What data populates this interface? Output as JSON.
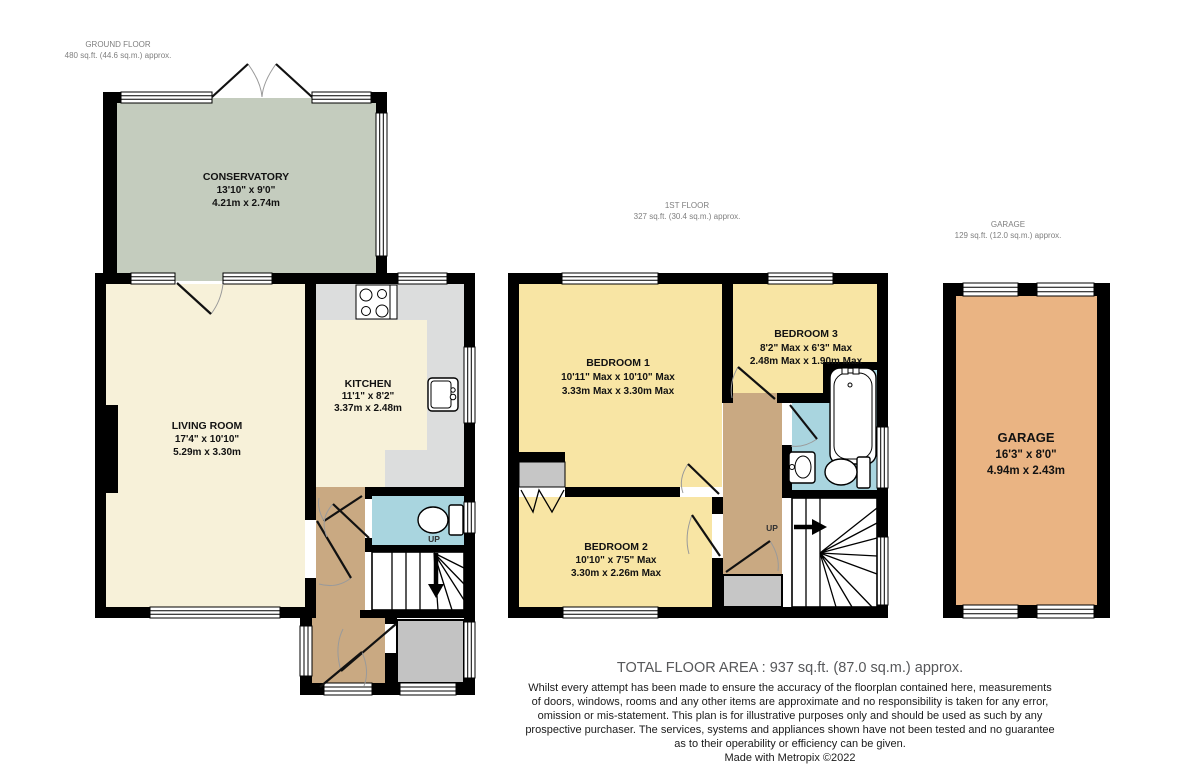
{
  "colors": {
    "wall": "#000000",
    "cream": "#f7f1d9",
    "yellow": "#f8e5a4",
    "green": "#c4ccbe",
    "tan": "#c9a982",
    "blue": "#a9d5df",
    "orange": "#eab483",
    "counter": "#dcdddd",
    "porch": "#c3c3c3",
    "cupboard": "#c6c6c6"
  },
  "ground_floor": {
    "header": {
      "line1": "GROUND FLOOR",
      "line2": "480 sq.ft. (44.6 sq.m.) approx."
    },
    "conservatory": {
      "name": "CONSERVATORY",
      "imperial": "13'10\"  x 9'0\"",
      "metric": "4.21m  x 2.74m"
    },
    "living_room": {
      "name": "LIVING ROOM",
      "imperial": "17'4\"  x 10'10\"",
      "metric": "5.29m  x 3.30m"
    },
    "kitchen": {
      "name": "KITCHEN",
      "imperial": "11'1\"  x 8'2\"",
      "metric": "3.37m  x 2.48m"
    },
    "stairs_label": "UP"
  },
  "first_floor": {
    "header": {
      "line1": "1ST FLOOR",
      "line2": "327 sq.ft. (30.4 sq.m.) approx."
    },
    "bedroom1": {
      "name": "BEDROOM 1",
      "imperial": "10'11\" Max x 10'10\" Max",
      "metric": "3.33m Max x 3.30m Max"
    },
    "bedroom2": {
      "name": "BEDROOM 2",
      "imperial": "10'10\"  x 7'5\" Max",
      "metric": "3.30m  x 2.26m Max"
    },
    "bedroom3": {
      "name": "BEDROOM 3",
      "imperial": "8'2\" Max x 6'3\" Max",
      "metric": "2.48m Max x 1.90m Max"
    },
    "stairs_label": "UP"
  },
  "garage": {
    "header": {
      "line1": "GARAGE",
      "line2": "129 sq.ft. (12.0 sq.m.) approx."
    },
    "room": {
      "name": "GARAGE",
      "imperial": "16'3\"  x 8'0\"",
      "metric": "4.94m  x 2.43m"
    }
  },
  "footer": {
    "total": "TOTAL FLOOR AREA : 937 sq.ft. (87.0 sq.m.) approx.",
    "disclaimer_lines": [
      "Whilst every attempt has been made to ensure the accuracy of the floorplan contained here, measurements",
      "of doors, windows, rooms and any other items are approximate and no responsibility is taken for any error,",
      "omission or mis-statement. This plan is for illustrative purposes only and should be used as such by any",
      "prospective purchaser. The services, systems and appliances shown have not been tested and no guarantee",
      "as to their operability or efficiency can be given."
    ],
    "credit": "Made with Metropix ©2022"
  }
}
